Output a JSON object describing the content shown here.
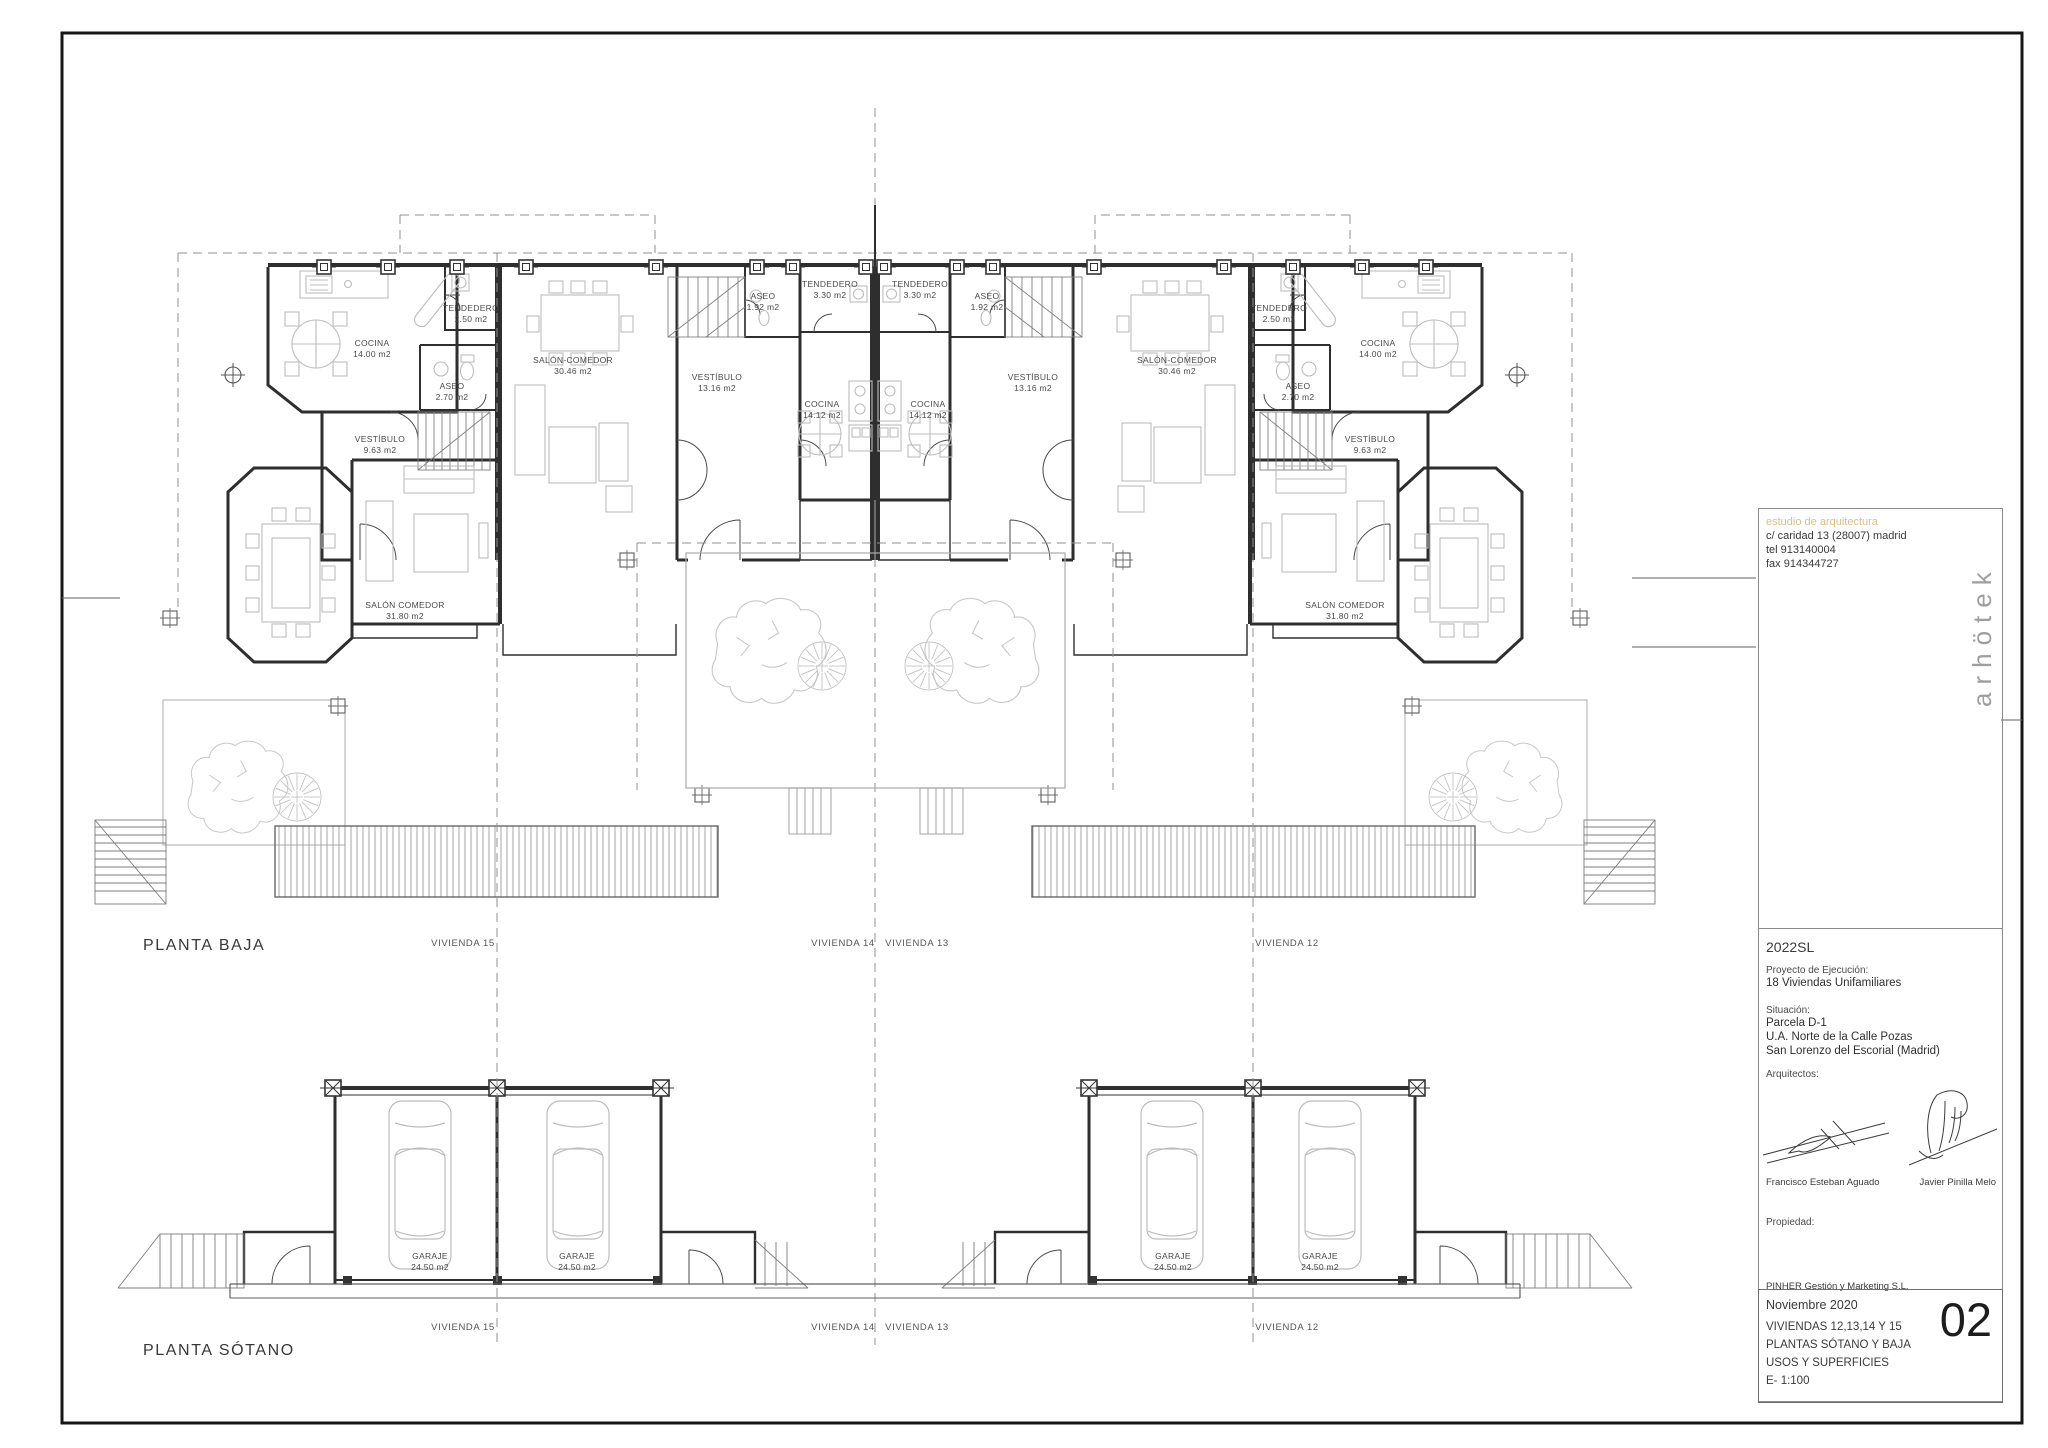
{
  "plan_baja": {
    "title": "PLANTA BAJA",
    "viviendas": [
      {
        "label": "VIVIENDA 15"
      },
      {
        "label": "VIVIENDA 14"
      },
      {
        "label": "VIVIENDA 13"
      },
      {
        "label": "VIVIENDA 12"
      }
    ],
    "rooms": [
      {
        "name": "COCINA",
        "area": "14.00 m2"
      },
      {
        "name": "TENDEDERO",
        "area": "2.50 m2"
      },
      {
        "name": "ASEO",
        "area": "2.70 m2"
      },
      {
        "name": "VESTÍBULO",
        "area": "9.63 m2"
      },
      {
        "name": "SALÓN COMEDOR",
        "area": "31.80 m2"
      },
      {
        "name": "SALÓN-COMEDOR",
        "area": "30.46 m2"
      },
      {
        "name": "VESTÍBULO",
        "area": "13.16 m2"
      },
      {
        "name": "ASEO",
        "area": "1.92 m2"
      },
      {
        "name": "TENDEDERO",
        "area": "3.30 m2"
      },
      {
        "name": "COCINA",
        "area": "14.12 m2"
      },
      {
        "name": "TENDEDERO",
        "area": "3.30 m2"
      },
      {
        "name": "ASEO",
        "area": "1.92 m2"
      },
      {
        "name": "COCINA",
        "area": "14.12 m2"
      },
      {
        "name": "VESTÍBULO",
        "area": "13.16 m2"
      },
      {
        "name": "SALÓN-COMEDOR",
        "area": "30.46 m2"
      },
      {
        "name": "TENDEDERO",
        "area": "2.50 m2"
      },
      {
        "name": "COCINA",
        "area": "14.00 m2"
      },
      {
        "name": "ASEO",
        "area": "2.70 m2"
      },
      {
        "name": "VESTÍBULO",
        "area": "9.63 m2"
      },
      {
        "name": "SALÓN COMEDOR",
        "area": "31.80 m2"
      }
    ]
  },
  "plan_sotano": {
    "title": "PLANTA SÓTANO",
    "viviendas": [
      {
        "label": "VIVIENDA 15"
      },
      {
        "label": "VIVIENDA 14"
      },
      {
        "label": "VIVIENDA 13"
      },
      {
        "label": "VIVIENDA 12"
      }
    ],
    "rooms": [
      {
        "name": "GARAJE",
        "area": "24.50 m2"
      },
      {
        "name": "GARAJE",
        "area": "24.50 m2"
      },
      {
        "name": "GARAJE",
        "area": "24.50 m2"
      },
      {
        "name": "GARAJE",
        "area": "24.50 m2"
      }
    ]
  },
  "titleblock": {
    "studio_line": "estudio de arquitectura",
    "address": "c/ caridad 13 (28007) madrid",
    "tel": "tel  913140004",
    "fax": "fax 914344727",
    "logo": "arhötek",
    "accent_color": "#d2c28a",
    "code": "2022SL",
    "project_label": "Proyecto de Ejecución:",
    "project_name": "18 Viviendas Unifamiliares",
    "situation_label": "Situación:",
    "situation_line1": "Parcela D-1",
    "situation_line2": "U.A. Norte de la Calle Pozas",
    "situation_line3": "San Lorenzo del Escorial (Madrid)",
    "architects_label": "Arquitectos:",
    "architect1": "Francisco Esteban Aguado",
    "architect2": "Javier Pinilla Melo",
    "property_label": "Propiedad:",
    "property_name": "PINHER Gestión y Marketing S.L.",
    "date": "Noviembre 2020",
    "drawing_line1": "VIVIENDAS 12,13,14 Y 15",
    "drawing_line2": "PLANTAS SÓTANO Y BAJA",
    "drawing_line3": "USOS Y SUPERFICIES",
    "scale": "E- 1:100",
    "sheet_number": "02"
  }
}
